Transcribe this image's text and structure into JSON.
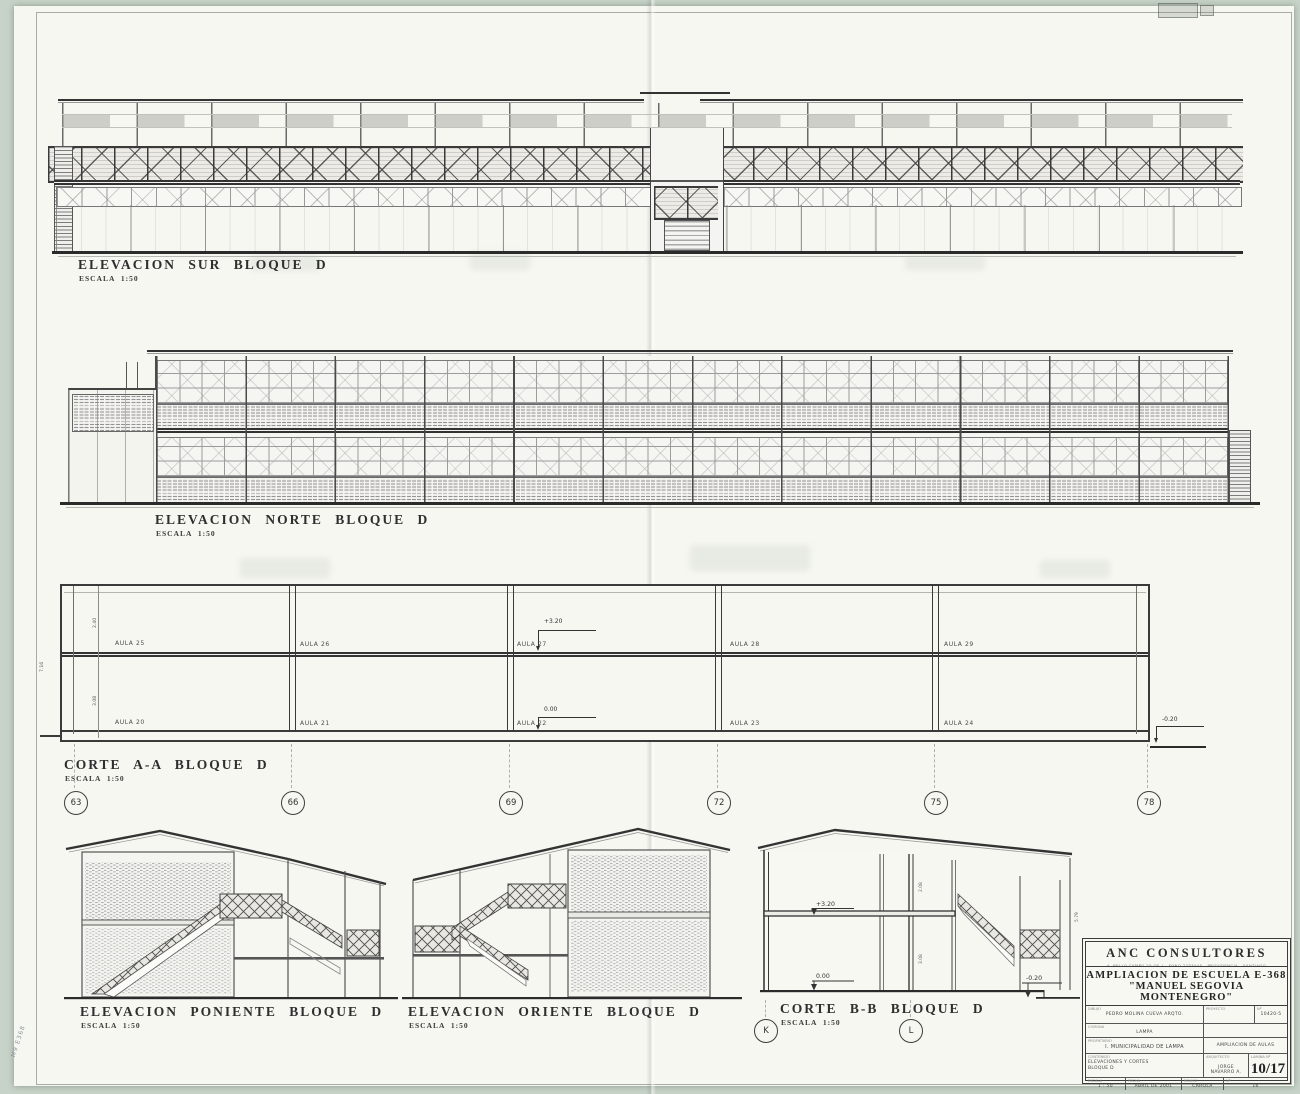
{
  "drawings": {
    "sur": {
      "title": "ELEVACION SUR BLOQUE D",
      "scale": "ESCALA 1:50"
    },
    "norte": {
      "title": "ELEVACION NORTE BLOQUE D",
      "scale": "ESCALA 1:50"
    },
    "corte_a": {
      "title": "CORTE A-A BLOQUE D",
      "scale": "ESCALA 1:50"
    },
    "poniente": {
      "title": "ELEVACION PONIENTE BLOQUE D",
      "scale": "ESCALA 1:50"
    },
    "oriente": {
      "title": "ELEVACION ORIENTE BLOQUE D",
      "scale": "ESCALA 1:50"
    },
    "corte_b": {
      "title": "CORTE B-B BLOQUE D",
      "scale": "ESCALA 1:50"
    }
  },
  "grid": {
    "columns": [
      "63",
      "66",
      "69",
      "72",
      "75",
      "78"
    ],
    "axes": [
      "K",
      "L"
    ]
  },
  "corte_a": {
    "rooms_upper": [
      "AULA 25",
      "AULA 26",
      "AULA 27",
      "AULA 28",
      "AULA 29"
    ],
    "rooms_lower": [
      "AULA 20",
      "AULA 21",
      "AULA 22",
      "AULA 23",
      "AULA 24"
    ],
    "levels": {
      "upper": "+3.20",
      "ground": "0.00",
      "exterior": "-0.20"
    },
    "dims": {
      "upper": "2.40",
      "lower": "3.08",
      "total": "7.16"
    }
  },
  "corte_b": {
    "levels": {
      "upper": "+3.20",
      "ground": "0.00",
      "exterior": "-0.20"
    },
    "dims": {
      "upper": "2.08",
      "lower": "3.08",
      "right": "5.79"
    }
  },
  "titleblock": {
    "company": "ANC CONSULTORES",
    "company_small": "A. BELLO CAMPO 25 OF. J - FONO 2233445 - PROVIDENCIA - SANTIAGO",
    "project_line1": "AMPLIACION DE ESCUELA E-368",
    "project_line2": "\"MANUEL SEGOVIA MONTENEGRO\"",
    "fields": {
      "dibujo_label": "DIBUJO",
      "dibujo": "PEDRO MOLINA CUEVA ARQTO.",
      "comuna_label": "COMUNA",
      "comuna": "LAMPA",
      "propietario_label": "PROPIETARIO",
      "propietario": "I. MUNICIPALIDAD DE LAMPA",
      "proyecto_label": "PROYECTO",
      "proyecto_note": "AMPLIACION DE AULAS",
      "num_label": "Nº",
      "num": "10420-5",
      "contenido_label": "CONTENIDO",
      "contenido1": "ELEVACIONES Y CORTES",
      "contenido2": "BLOQUE D",
      "arquitecto_label": "ARQUITECTO",
      "arquitecto": "JORGE NAVARRO A.",
      "lamina_label": "LAMINA Nº",
      "lamina": "10/17",
      "escala_label": "ESCALA",
      "escala": "1 : 50",
      "fecha_label": "FECHA",
      "fecha": "ABRIL DE 2001",
      "rev_label": "REVISO",
      "rev": "CAROLA",
      "hoja_label": "Nº",
      "hoja": "16"
    }
  },
  "corner_note": "M9 E368"
}
